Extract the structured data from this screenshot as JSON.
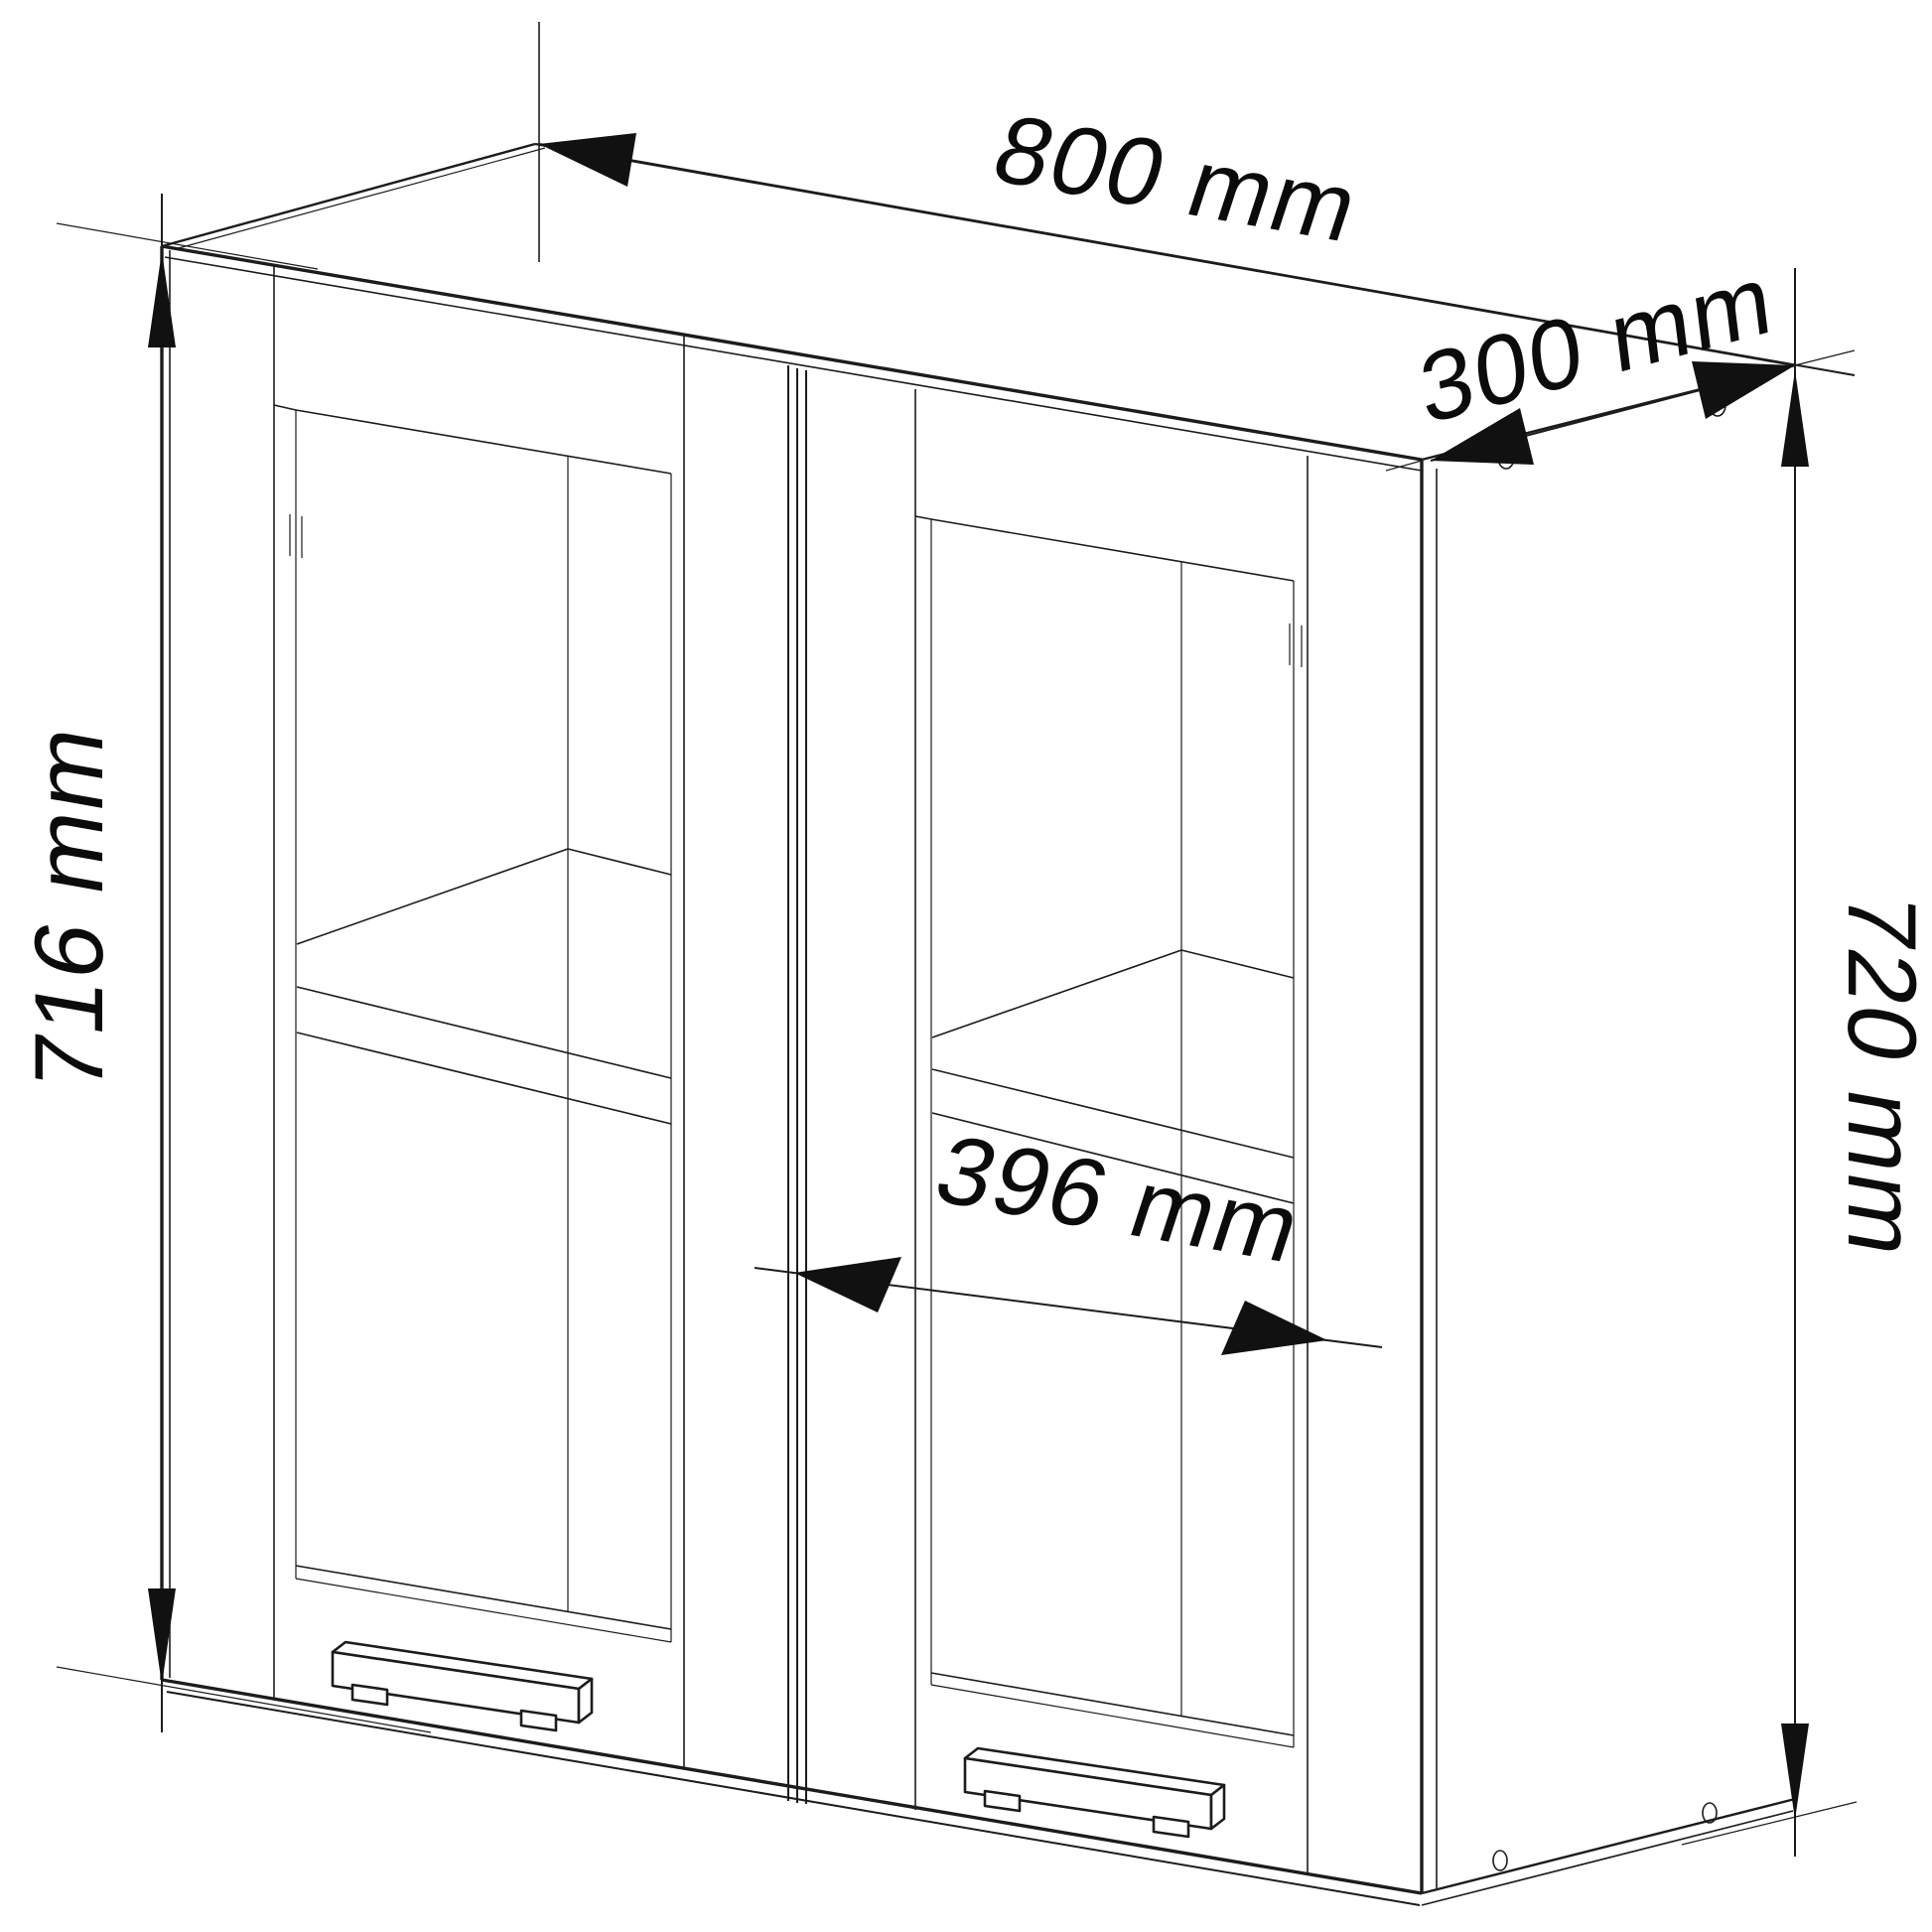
{
  "unit": "mm",
  "colors": {
    "line": "#1c1c1c",
    "background": "#ffffff"
  },
  "dims": {
    "width": {
      "label": "800 mm",
      "value": 800
    },
    "depth": {
      "label": "300 mm",
      "value": 300
    },
    "front_height": {
      "label": "716 mm",
      "value": 716
    },
    "side_height": {
      "label": "720 mm",
      "value": 720
    },
    "door_width": {
      "label": "396 mm",
      "value": 396
    }
  }
}
